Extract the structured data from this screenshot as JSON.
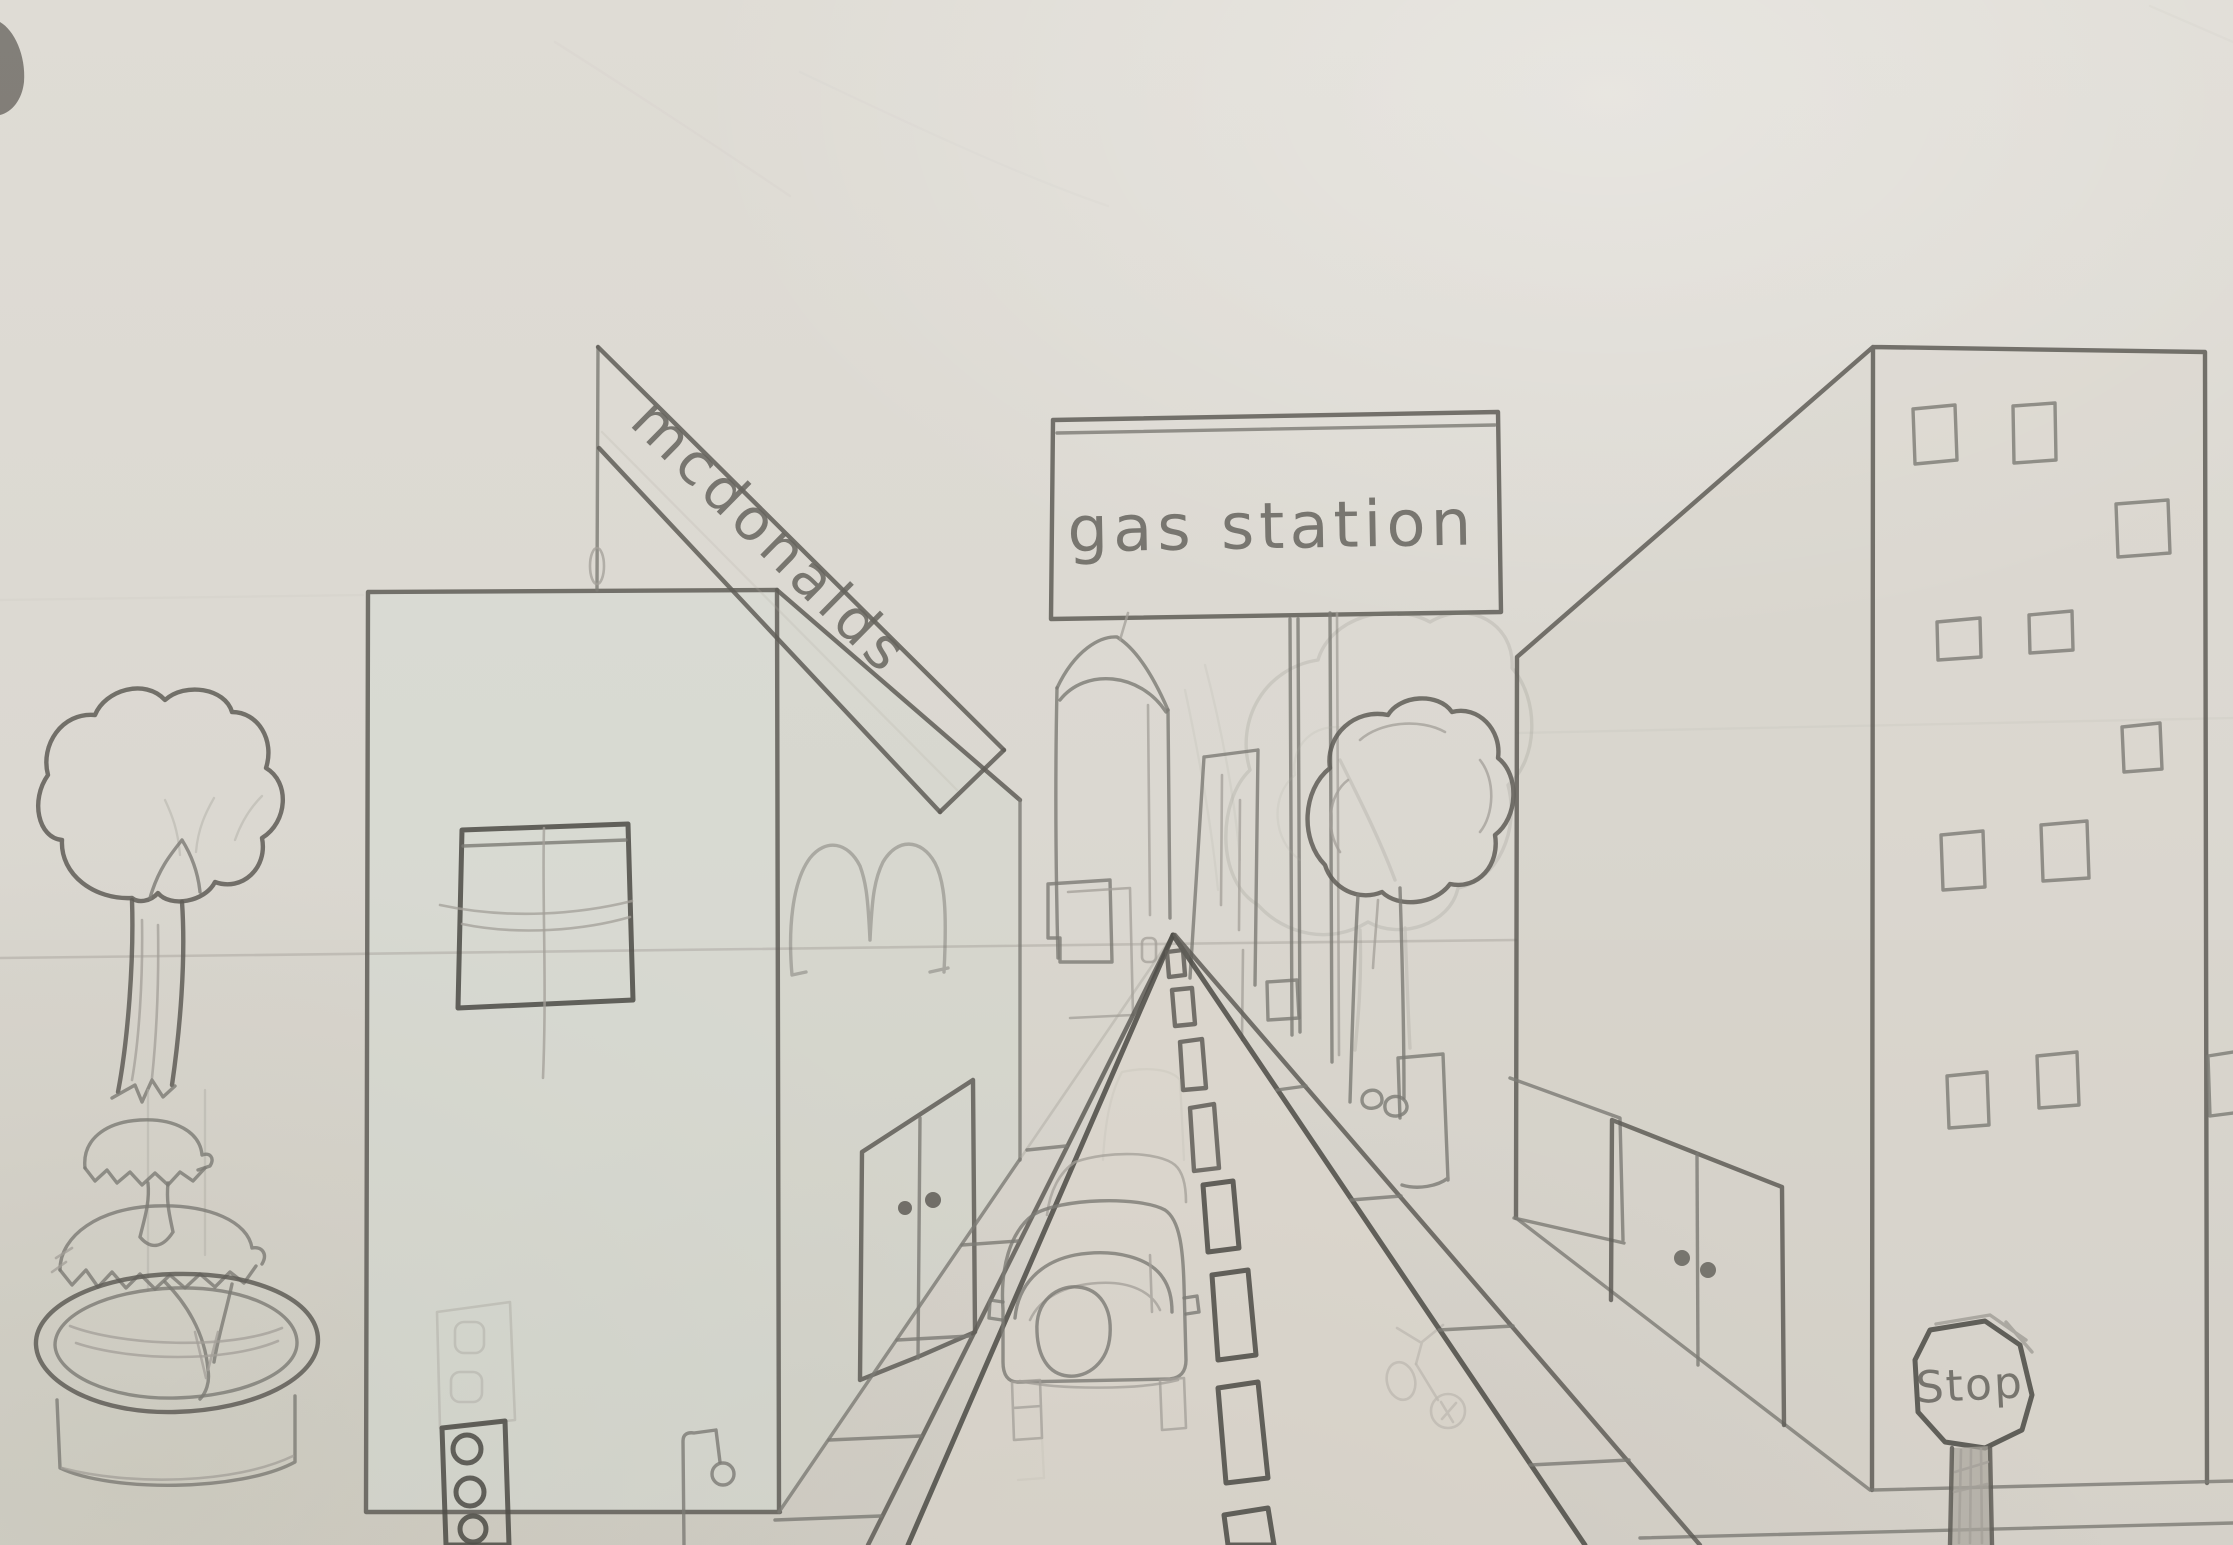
{
  "artwork": {
    "title": "One-point perspective city street pencil drawing",
    "medium": "graphite pencil on paper"
  },
  "signs": {
    "mcdonalds": {
      "text": "mcdonalds"
    },
    "gas_station": {
      "text": "gas station"
    },
    "stop": {
      "text": "Stop"
    }
  },
  "palette": {
    "paper": "#dcd8d1",
    "paper_shadow": "#cfccc4",
    "pencil_dark": "#504e49",
    "pencil_mid": "#7c7a74",
    "pencil_light": "#a39f98",
    "left_building_tint": "#d6dbd3"
  },
  "elements": [
    "left-tree",
    "fountain",
    "left-building",
    "window-grid",
    "golden-arches-m",
    "double-door-left",
    "traffic-light",
    "street-lamp",
    "mcdonalds-banner",
    "gas-station-billboard",
    "sign-posts",
    "obelisk-tower",
    "city-blocks",
    "faint-tree",
    "right-tree",
    "bench-box",
    "bicycle",
    "right-building",
    "double-door-right",
    "stop-sign",
    "road",
    "center-dash-line",
    "car-rear",
    "horizon-line"
  ]
}
